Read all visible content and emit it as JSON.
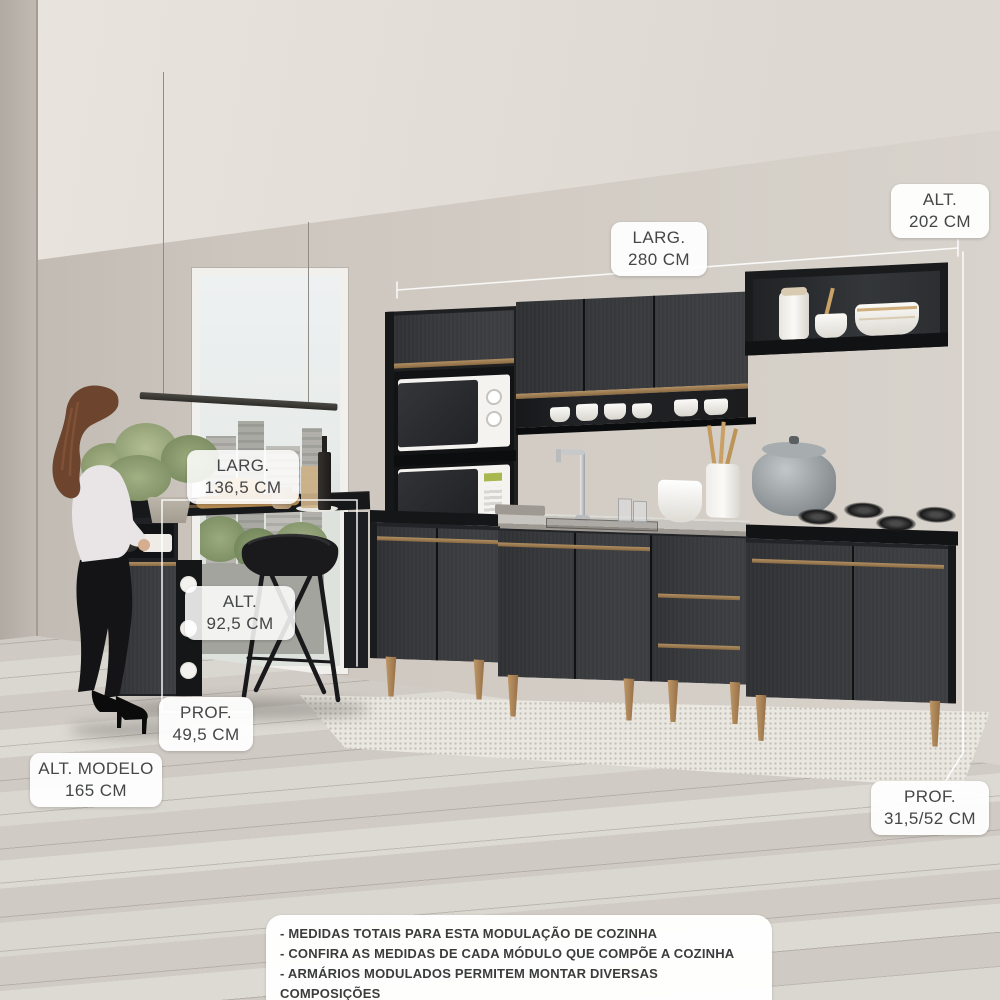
{
  "labels": {
    "alt_total": {
      "line1": "ALT.",
      "line2": "202 CM"
    },
    "larg_total": {
      "line1": "LARG.",
      "line2": "280 CM"
    },
    "larg_island": {
      "line1": "LARG.",
      "line2": "136,5 CM"
    },
    "alt_island": {
      "line1": "ALT.",
      "line2": "92,5 CM"
    },
    "prof_island": {
      "line1": "PROF.",
      "line2": "49,5 CM"
    },
    "alt_model": {
      "line1": "ALT. MODELO",
      "line2": "165 CM"
    },
    "prof_total": {
      "line1": "PROF.",
      "line2": "31,5/52 CM"
    }
  },
  "notes": {
    "line1": "- MEDIDAS TOTAIS PARA ESTA MODULAÇÃO DE COZINHA",
    "line2": "- CONFIRA AS MEDIDAS DE CADA MÓDULO QUE COMPÕE A COZINHA",
    "line3": "- ARMÁRIOS MODULADOS PERMITEM MONTAR DIVERSAS COMPOSIÇÕES"
  },
  "colors": {
    "wall": "#cfc9c1",
    "ceiling": "#e5e1da",
    "floor": "#d6d2cb",
    "rug": "#eae7e0",
    "cabinet": "#36373a",
    "cabinet_dark": "#141517",
    "bronze_handle": "#a58356",
    "countertop_gray": "#c8c5c0",
    "label_background": "#ffffff",
    "label_text": "#454647"
  }
}
